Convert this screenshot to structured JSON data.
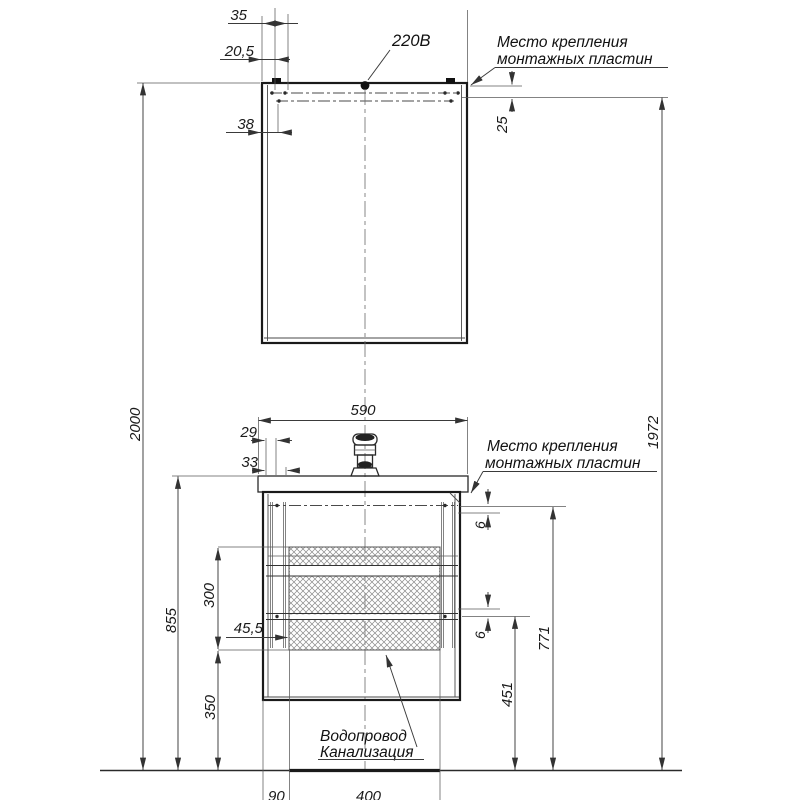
{
  "labels": {
    "power": "220В",
    "mount_top": {
      "line1": "Место крепления",
      "line2": "монтажных пластин"
    },
    "mount_bottom": {
      "line1": "Место крепления",
      "line2": "монтажных пластин"
    },
    "water": {
      "line1": "Водопровод",
      "line2": "Канализация"
    }
  },
  "dims": {
    "m35": "35",
    "m20_5": "20,5",
    "m38": "38",
    "m25": "25",
    "h2000": "2000",
    "h1972": "1972",
    "h855": "855",
    "h771": "771",
    "h451": "451",
    "h350": "350",
    "h300": "300",
    "v590": "590",
    "v29": "29",
    "v33": "33",
    "v6a": "6",
    "v6b": "6",
    "v45_5": "45,5",
    "f90": "90",
    "f400": "400"
  },
  "colors": {
    "line": "#1a1a1a",
    "hatch": "#777777",
    "background": "#ffffff"
  }
}
